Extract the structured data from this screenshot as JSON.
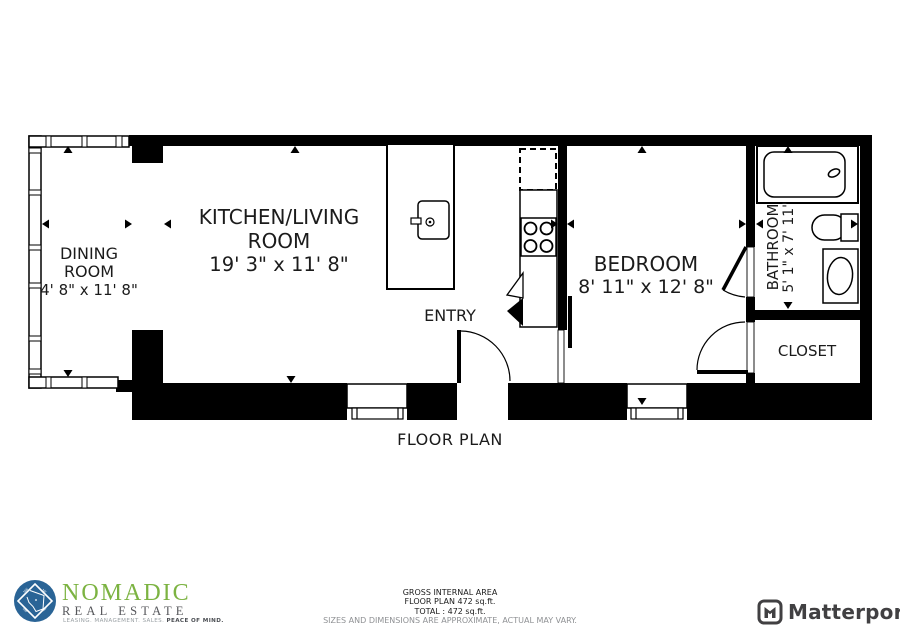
{
  "labels": {
    "dining_l1": "DINING",
    "dining_l2": "ROOM",
    "dining_dims": "4' 8\" x 11' 8\"",
    "kitchen_l1": "KITCHEN/LIVING",
    "kitchen_l2": "ROOM",
    "kitchen_dims": "19' 3\" x 11' 8\"",
    "entry": "ENTRY",
    "bedroom": "BEDROOM",
    "bedroom_dims": "8' 11\" x 12' 8\"",
    "bathroom": "BATHROOM",
    "bathroom_dims": "5' 1\" x 7' 11\"",
    "closet": "CLOSET",
    "plan_title": "FLOOR PLAN"
  },
  "footer": {
    "area_line1": "GROSS INTERNAL AREA",
    "area_line2": "FLOOR PLAN 472 sq.ft.",
    "area_line3": "TOTAL :  472 sq.ft.",
    "disclaimer": "SIZES AND DIMENSIONS ARE APPROXIMATE, ACTUAL MAY VARY.",
    "nomadic_name": "NOMADIC",
    "nomadic_subtitle": "REAL ESTATE",
    "nomadic_tagline_gray": "LEASING. MANAGEMENT. SALES. ",
    "nomadic_tagline_bold": "PEACE OF MIND.",
    "matterport_name": "Matterport"
  },
  "colors": {
    "wall": "#000000",
    "nomadic_green": "#7cb342",
    "nomadic_blue": "#2a6496",
    "nomadic_gray": "#55565a",
    "matterport": "#414042",
    "disclaimer_gray": "#8f9194"
  }
}
